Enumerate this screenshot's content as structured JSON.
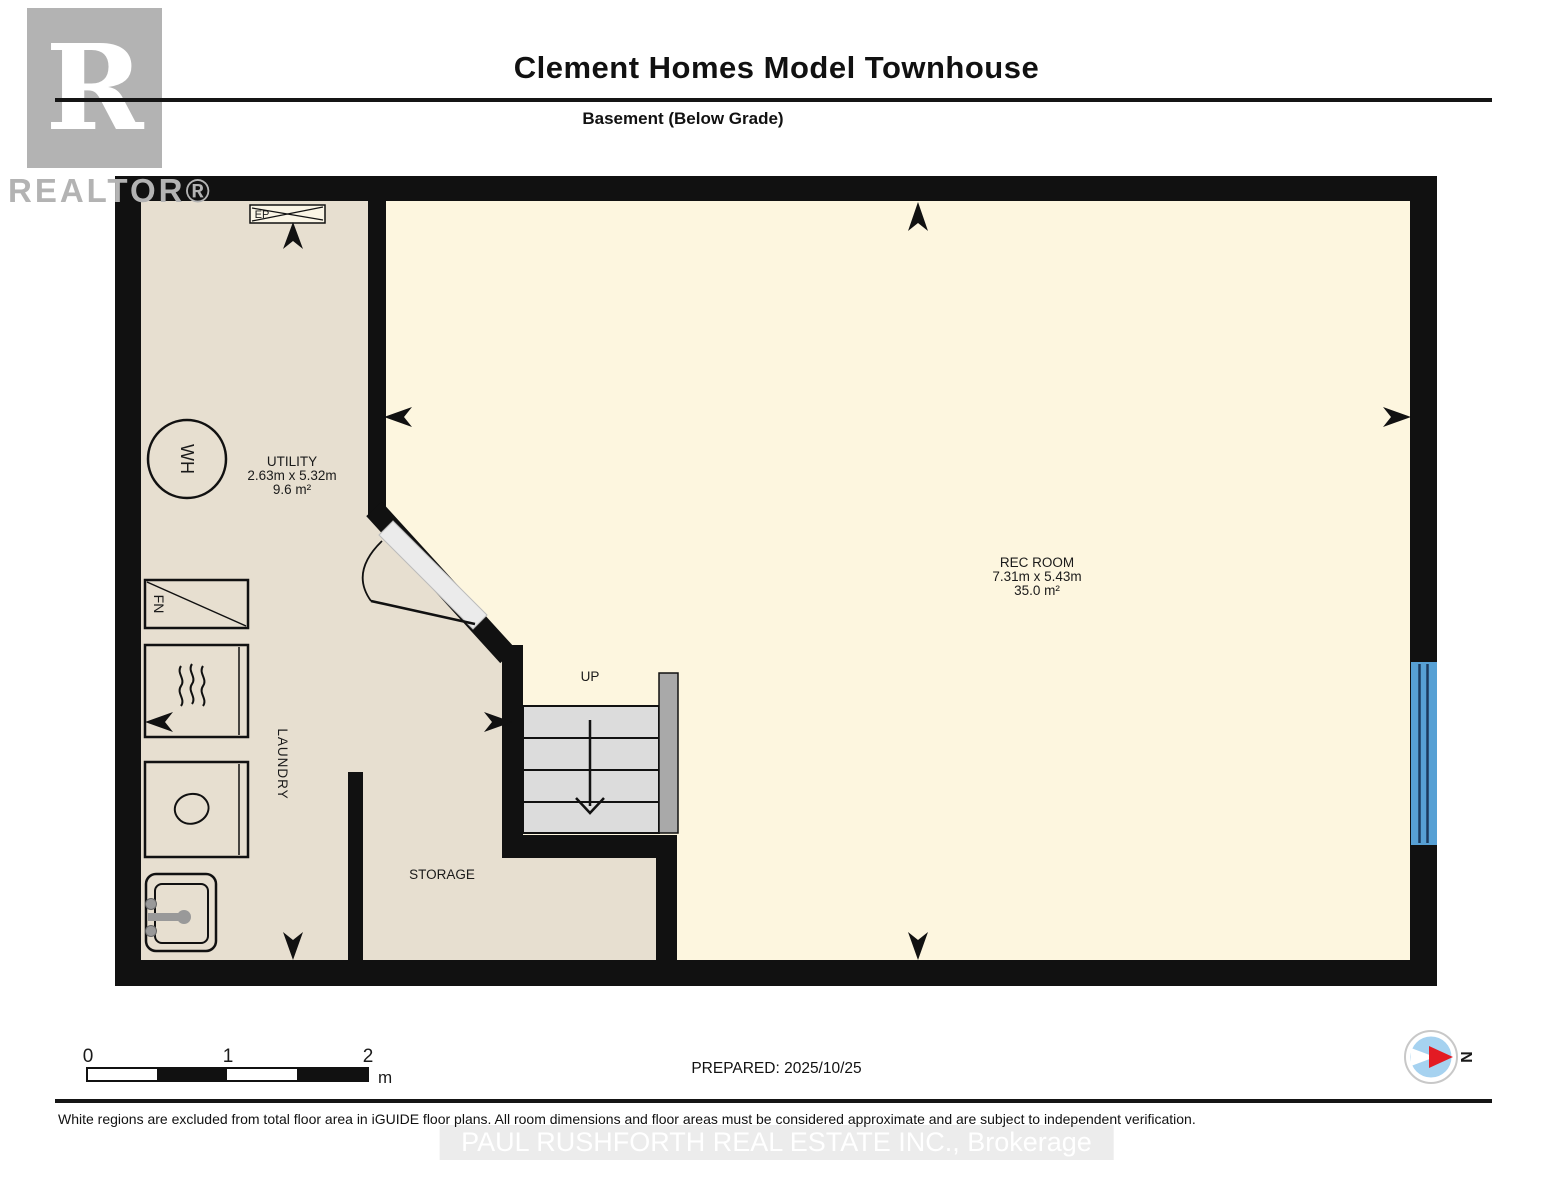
{
  "header": {
    "title": "Clement Homes Model Townhouse",
    "subtitle": "Basement (Below Grade)"
  },
  "branding": {
    "logo_letter": "R",
    "logo_wordmark": "REALTOR®",
    "watermark": "PAUL RUSHFORTH REAL ESTATE INC., Brokerage"
  },
  "rooms": {
    "utility": {
      "name": "UTILITY",
      "dimensions": "2.63m x 5.32m",
      "area": "9.6 m²"
    },
    "rec_room": {
      "name": "REC ROOM",
      "dimensions": "7.31m x 5.43m",
      "area": "35.0 m²"
    },
    "laundry": {
      "name": "LAUNDRY"
    },
    "storage": {
      "name": "STORAGE"
    }
  },
  "fixtures": {
    "water_heater": "WH",
    "furnace": "FN",
    "electrical_panel": "EP",
    "stairs_direction": "UP"
  },
  "scale_bar": {
    "ticks": [
      "0",
      "1",
      "2"
    ],
    "unit": "m"
  },
  "compass": {
    "north": "N"
  },
  "footer": {
    "prepared": "PREPARED: 2025/10/25",
    "disclaimer": "White regions are excluded from total floor area in iGUIDE floor plans. All room dimensions and floor areas must be considered approximate and are subject to independent verification."
  },
  "colors": {
    "wall": "#111111",
    "floor_included": "#fdf6df",
    "floor_excluded": "#e7dfd0",
    "stairs": "#dcdcdc",
    "window_blue": "#57a0d4",
    "compass_blue": "#a6d2f0",
    "compass_red": "#e31b23",
    "logo_gray": "#b3b3b3"
  }
}
